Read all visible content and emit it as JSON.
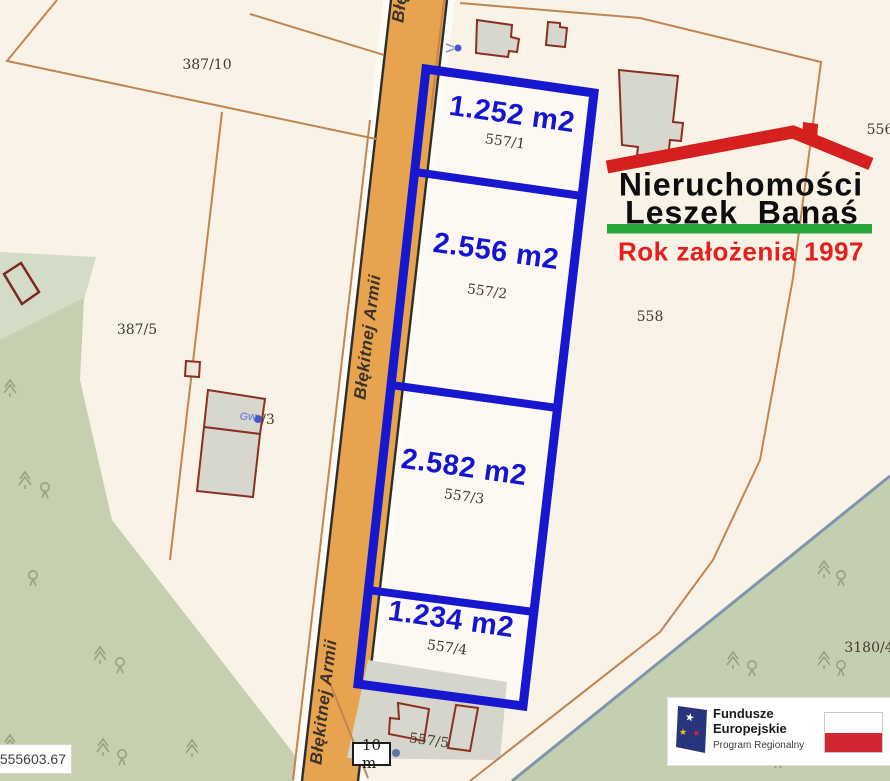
{
  "parcels": {
    "featured": [
      {
        "area_label": "1.252 m2",
        "parcel_number": "557/1"
      },
      {
        "area_label": "2.556 m2",
        "parcel_number": "557/2"
      },
      {
        "area_label": "2.582 m2",
        "parcel_number": "557/3"
      },
      {
        "area_label": "1.234 m2",
        "parcel_number": "557/4"
      }
    ],
    "labels": {
      "p387_10": "387/10",
      "p387_5": "387/5",
      "p557_5": "557/5",
      "p558": "558",
      "p556": "556",
      "p3180_4": "3180/4",
      "p_3": "/3",
      "gw": "Gw"
    }
  },
  "road": {
    "name": "Błękitnej Armii"
  },
  "logo": {
    "line1": "Nieruchomości",
    "line2": "Leszek Banaś",
    "tagline": "Rok założenia 1997"
  },
  "eu_banner": {
    "program_line1": "Fundusze",
    "program_line2": "Europejskie",
    "program_sub": "Program Regionalny"
  },
  "scale": {
    "label": "10 m"
  },
  "coordinates": {
    "label": "555603.67"
  },
  "icons": {
    "star": "★"
  },
  "colors": {
    "featured_outline": "#1717cf",
    "area_text": "#1515cf",
    "road_fill": "#e8a34e",
    "boundary_line": "#c08550",
    "building_outline": "#8a2f23",
    "green_area": "#c6cfb0",
    "ditch_blue": "#8095ac",
    "logo_red": "#d6201f",
    "logo_green": "#27a737",
    "tagline_red": "#e3201d",
    "flag_red": "#d22630",
    "eu_navy": "#28347c"
  }
}
